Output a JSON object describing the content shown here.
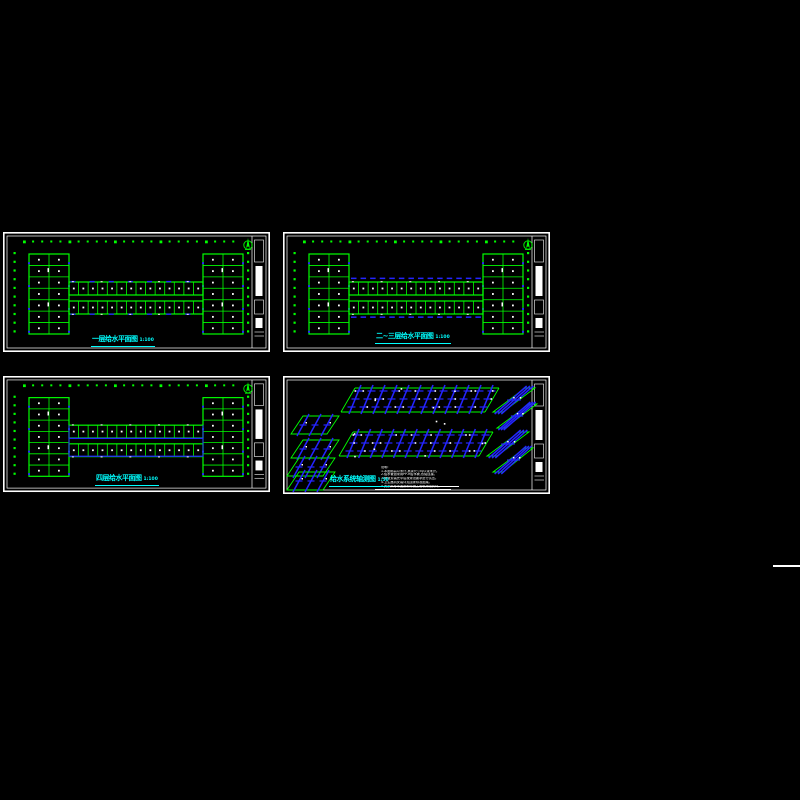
{
  "canvas": {
    "background": "#000000"
  },
  "colors": {
    "frame": "#ffffff",
    "plan_green": "#00ff00",
    "pipe_blue": "#2424ff",
    "title_cyan": "#00ffff",
    "note_white": "#ffffff"
  },
  "panels": [
    {
      "id": "plan-1",
      "type": "plan",
      "variant": "base",
      "title": "一层给水平面图",
      "scale": "1:100"
    },
    {
      "id": "plan-2",
      "type": "plan",
      "variant": "dims",
      "title": "二~三层给水平面图",
      "scale": "1:100"
    },
    {
      "id": "plan-3",
      "type": "plan",
      "variant": "inner-blue",
      "title": "四层给水平面图",
      "scale": "1:100"
    },
    {
      "id": "axon",
      "type": "axon",
      "title": "给水系统轴测图",
      "scale": "1:50",
      "notes": [
        "说明:",
        "1.本图标高以米计,其余尺寸均以毫米计。",
        "2.给水管道采用PP-R给水管,热熔连接。",
        "3.管道安装完毕后按规范要求进行试压。",
        "4.卫生器具安装详见国家标准图集。",
        "5.其余未尽事宜按现行施工验收规范执行。"
      ]
    }
  ],
  "plan_geometry": {
    "corridor_rooms_per_bar": 14,
    "corridor_bars": 2,
    "wing_rows": 7,
    "wing_cols": 2,
    "axis_dots_top": 24,
    "axis_dots_side": 10
  },
  "axon_geometry": {
    "bands": 2,
    "risers_per_band": 12,
    "end_blocks_per_band": 4
  },
  "icons": {
    "north_arrow": "north-arrow-icon"
  }
}
